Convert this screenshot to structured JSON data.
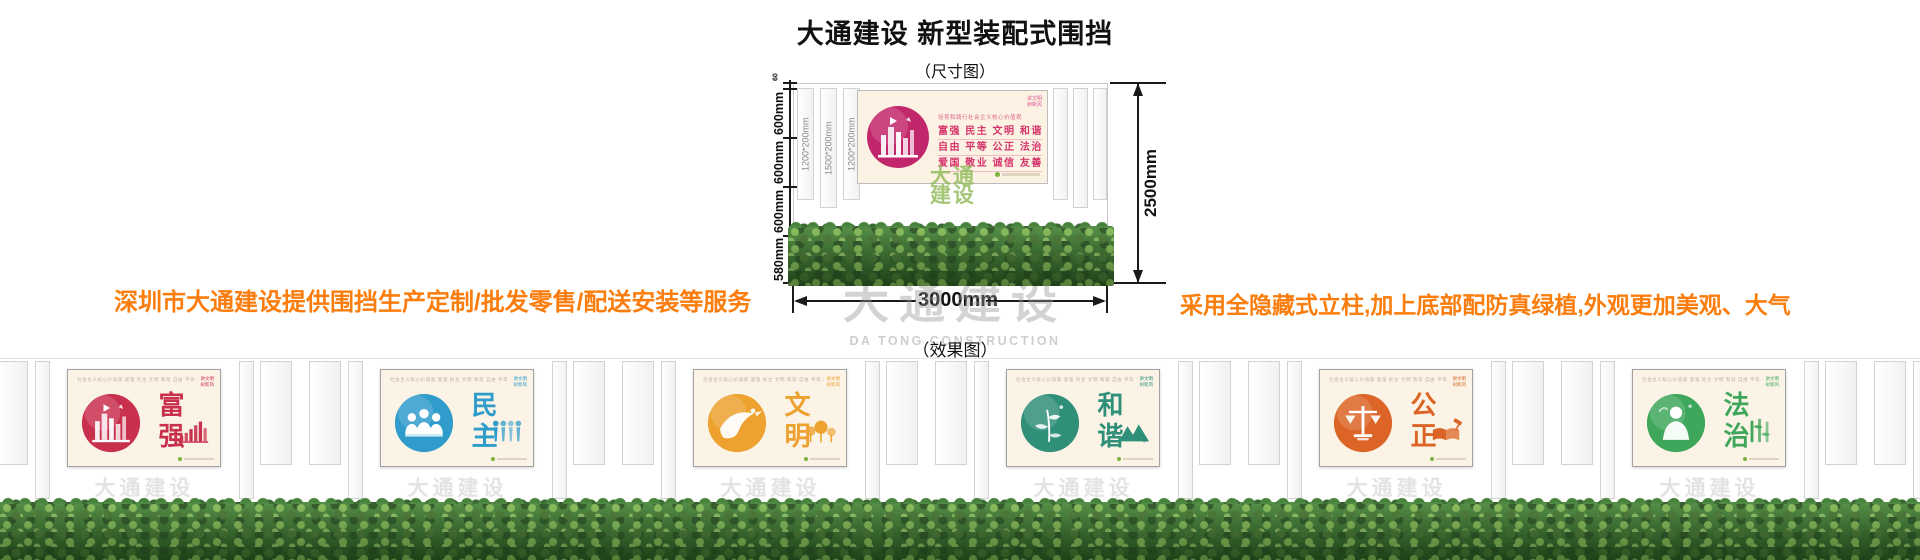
{
  "header": {
    "title": "大通建设 新型装配式围挡",
    "size_diagram_label": "（尺寸图）",
    "effect_diagram_label": "（效果图）"
  },
  "notes": {
    "left": "深圳市大通建设提供围挡生产定制/批发零售/配送安装等服务",
    "right": "采用全隐藏式立柱,加上底部配防真绿植,外观更加美观、大气",
    "color": "#FB7D0D"
  },
  "dimensions": {
    "total_height": "2500mm",
    "total_width": "3000mm",
    "height_segments": [
      "60",
      "600mm",
      "600mm",
      "600mm",
      "580mm"
    ],
    "post_sizes": [
      "1200*200mm",
      "1500*200mm",
      "1200*200mm"
    ]
  },
  "sample_panel": {
    "slogan_header": "培育和践行社会主义核心价值观",
    "corner_tag_line1": "讲文明",
    "corner_tag_line2": "树新风",
    "values_rows": [
      "富强 民主 文明 和谐",
      "自由 平等 公正 法治",
      "爱国 敬业 诚信 友善"
    ],
    "text_color": "#D6336C",
    "circle_color": "#C2266B"
  },
  "watermark": {
    "cn": "大通建设",
    "en": "DA TONG CONSTRUCTION",
    "diagram_badge_line1": "大通",
    "diagram_badge_line2": "建设"
  },
  "effect_panels": {
    "micro_header": "社会主义核心价值观 富强 民主 文明 和谐 自由 平等 公正 法治 爱国 敬业 诚信 友善",
    "corner_tag_line1": "讲文明",
    "corner_tag_line2": "树新风"
  },
  "panels": [
    {
      "word": "富强",
      "color": "#C8304E",
      "motif": "city-skyline",
      "icon": "bar-chart"
    },
    {
      "word": "民主",
      "color": "#2F9CCB",
      "motif": "people-holding-hands",
      "icon": "people-marks"
    },
    {
      "word": "文明",
      "color": "#EDA12F",
      "motif": "crane-bird",
      "icon": "trees"
    },
    {
      "word": "和谐",
      "color": "#2F8F79",
      "motif": "forest-leaves",
      "icon": "mountains"
    },
    {
      "word": "公正",
      "color": "#DB6426",
      "motif": "scales-of-justice",
      "icon": "book-and-gavel"
    },
    {
      "word": "法治",
      "color": "#3FA75B",
      "motif": "figure-silhouette",
      "icon": "bamboo"
    }
  ],
  "hedge_color": "#35682C"
}
